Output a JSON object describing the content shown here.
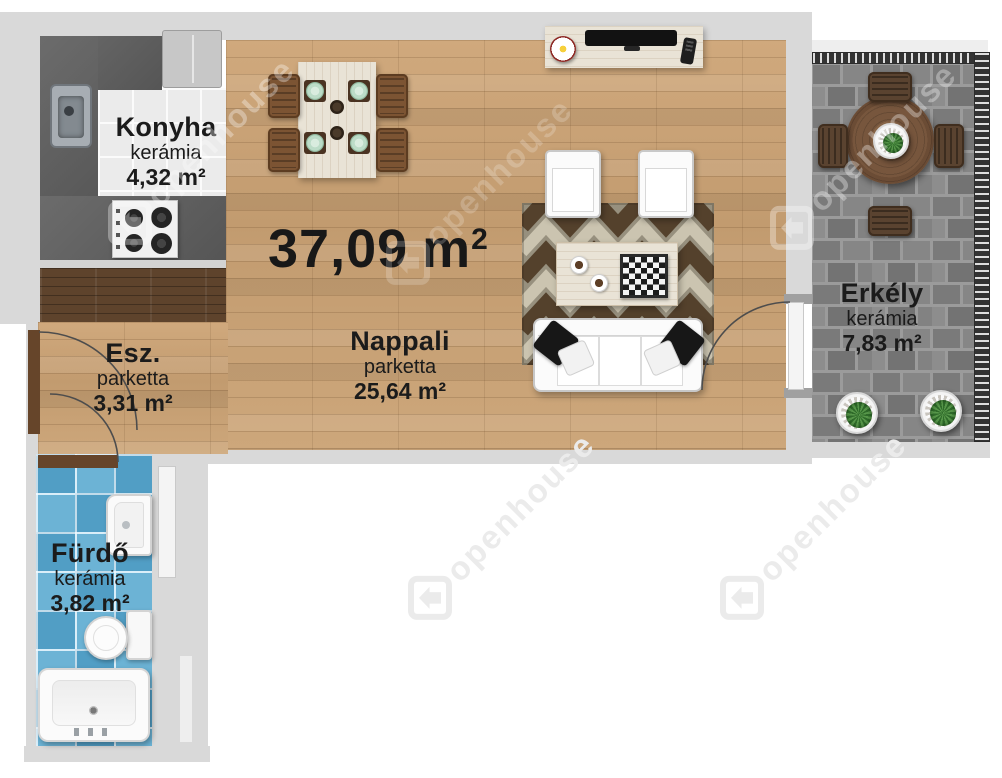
{
  "total_area": {
    "value": "37,09",
    "unit": "m",
    "sup": "2"
  },
  "rooms": {
    "konyha": {
      "name": "Konyha",
      "floor": "kerámia",
      "area": "4,32 m²"
    },
    "nappali": {
      "name": "Nappali",
      "floor": "parketta",
      "area": "25,64 m²"
    },
    "esz": {
      "name": "Esz.",
      "floor": "parketta",
      "area": "3,31 m²"
    },
    "furdo": {
      "name": "Fürdő",
      "floor": "kerámia",
      "area": "3,82 m²"
    },
    "erkely": {
      "name": "Erkély",
      "floor": "kerámia",
      "area": "7,83 m²"
    }
  },
  "watermark": {
    "text": "openhouse",
    "logo_icon": "openhouse-house-icon"
  },
  "colors": {
    "wall_gray": "#d9d9d9",
    "parquet_wood": "#c9a376",
    "dark_wood": "#5e432c",
    "kitchen_counter": "#5f5f5f",
    "bathroom_tile_blue": "#58a8cf",
    "balcony_brick_gray": "#7d7d7d",
    "rug_brown": "#54412c",
    "rug_cream": "#cbc4b0",
    "label_text": "#1b1b1b"
  }
}
